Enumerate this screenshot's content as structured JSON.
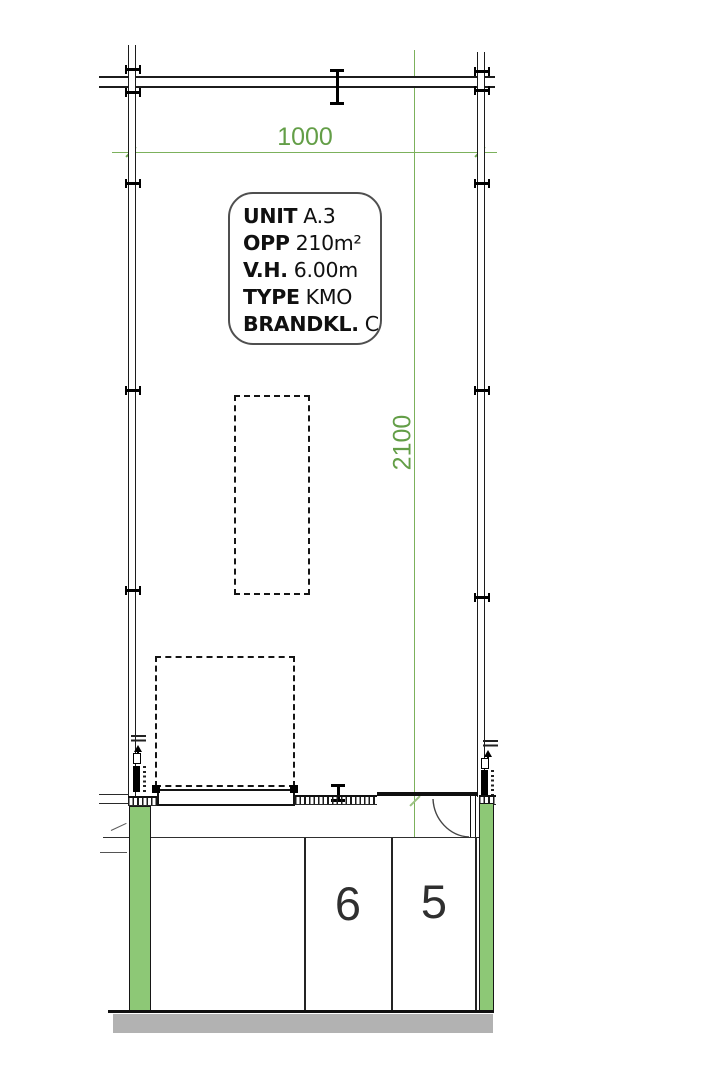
{
  "unit_box": {
    "rows": [
      {
        "label": "UNIT",
        "value": "A.3"
      },
      {
        "label": "OPP",
        "value": "210m²"
      },
      {
        "label": "V.H.",
        "value": "6.00m"
      },
      {
        "label": "TYPE",
        "value": "KMO"
      },
      {
        "label": "BRANDKL.",
        "value": "C"
      }
    ]
  },
  "dimensions": {
    "width_label": "1000",
    "height_label": "2100"
  },
  "parking": {
    "space_labels": [
      "6",
      "5"
    ]
  },
  "colors": {
    "dimension_green": "#6fa750",
    "column_green": "#8dc876",
    "wall_black": "#1c1c1c",
    "road_gray": "#b2b2b2"
  }
}
